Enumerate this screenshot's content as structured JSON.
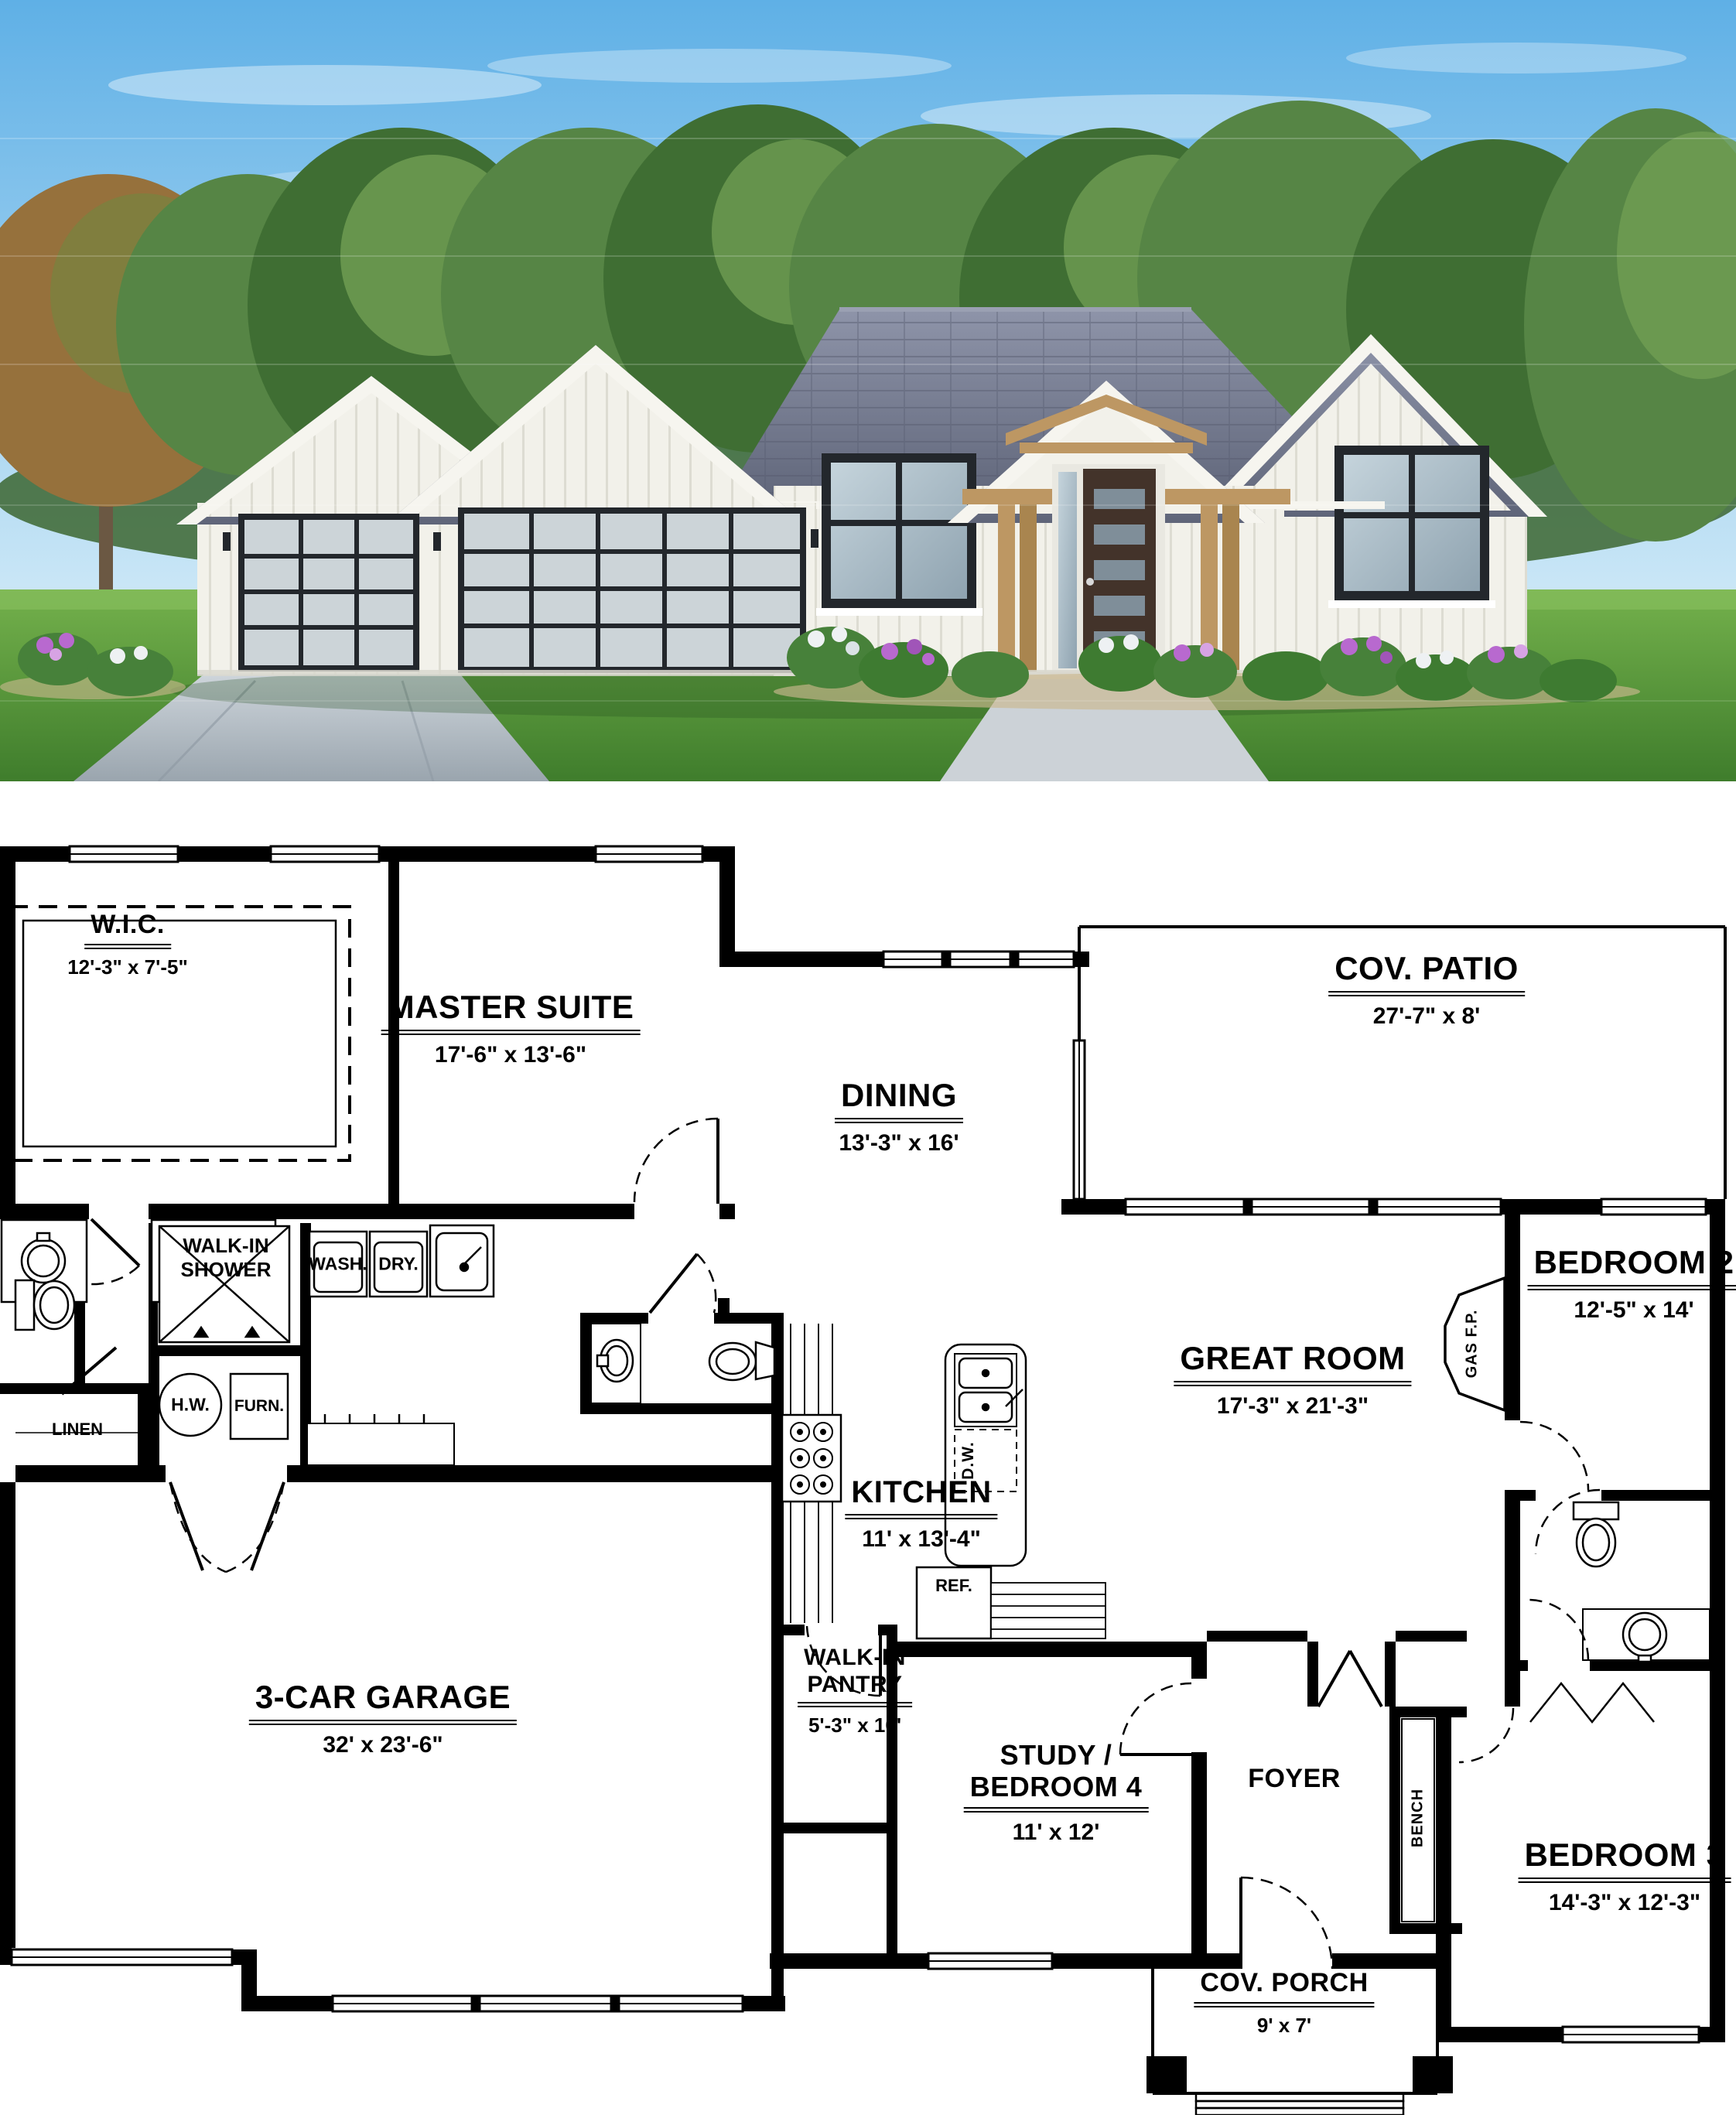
{
  "colors": {
    "sky_top": "#5fb0e6",
    "sky_bottom": "#cfe9f7",
    "tree_dark": "#3f6e33",
    "tree_mid": "#568545",
    "tree_light": "#6f9c52",
    "tree_olive": "#7d7f3e",
    "tree_rust": "#96713c",
    "grass": "#5d9c3f",
    "grass_dark": "#3f7d2c",
    "roof": "#7d8398",
    "roof_dark": "#5f6579",
    "wall_white": "#f2f1ea",
    "door_wood": "#43332a",
    "post_wood": "#bd9763",
    "glass": "#a9bcc8",
    "garage_glass": "#ccd4d8",
    "frame_dark": "#23272c",
    "driveway": "#b9c3cc",
    "flower_purple": "#b869cf",
    "flower_white": "#eef1f3",
    "shrub": "#47813a",
    "walkway": "#ccd2d7",
    "plan_line": "#000000"
  },
  "plan": {
    "rooms": {
      "wic": {
        "label": "W.I.C.",
        "dims": "12'-3\" x 7'-5\""
      },
      "master": {
        "label": "MASTER SUITE",
        "dims": "17'-6\" x 13'-6\""
      },
      "dining": {
        "label": "DINING",
        "dims": "13'-3\" x 16'"
      },
      "patio": {
        "label": "COV. PATIO",
        "dims": "27'-7\" x 8'"
      },
      "bedroom2": {
        "label": "BEDROOM 2",
        "dims": "12'-5\" x 14'"
      },
      "great": {
        "label": "GREAT ROOM",
        "dims": "17'-3\" x 21'-3\""
      },
      "kitchen": {
        "label": "KITCHEN",
        "dims": "11' x 13'-4\""
      },
      "pantry": {
        "label1": "WALK-IN",
        "label2": "PANTRY",
        "dims": "5'-3\" x 10'"
      },
      "garage": {
        "label": "3-CAR GARAGE",
        "dims": "32' x 23'-6\""
      },
      "study": {
        "label1": "STUDY /",
        "label2": "BEDROOM 4",
        "dims": "11' x 12'"
      },
      "foyer": {
        "label": "FOYER"
      },
      "bedroom3": {
        "label": "BEDROOM 3",
        "dims": "14'-3\" x 12'-3\""
      },
      "porch": {
        "label": "COV. PORCH",
        "dims": "9' x 7'"
      }
    },
    "fixtures": {
      "shower1": "WALK-IN",
      "shower2": "SHOWER",
      "wash": "WASH.",
      "dry": "DRY.",
      "linen": "LINEN",
      "hw": "H.W.",
      "furn": "FURN.",
      "ref": "REF.",
      "dw": "D.W.",
      "gas_fp": "GAS  F.P.",
      "bench": "BENCH"
    }
  }
}
